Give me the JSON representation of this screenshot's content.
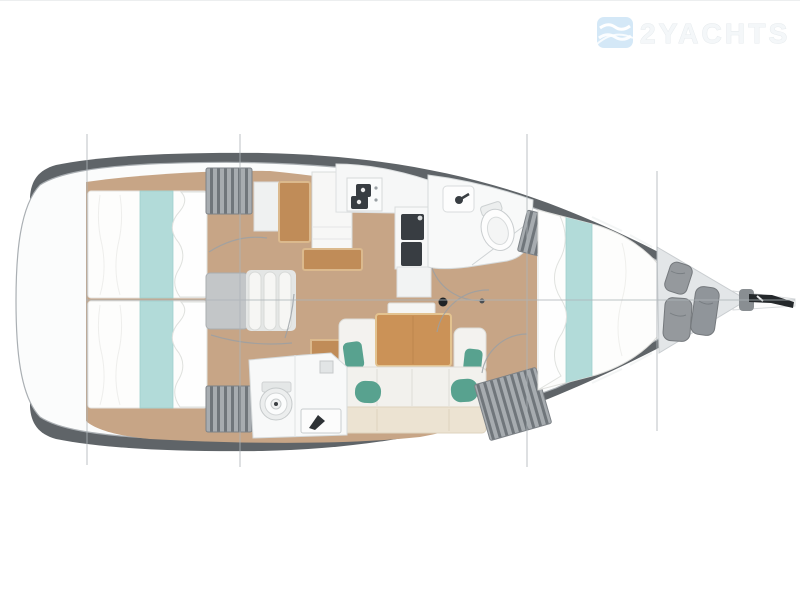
{
  "watermark": {
    "logo_icon": "waves-logo-icon",
    "text": "2YACHTS"
  },
  "colors": {
    "background": "#ffffff",
    "hull_rim": "#5f6468",
    "deck": "#fbfcfc",
    "floor_wood": "#c7a586",
    "furniture_wood": "#c08c58",
    "bed_teal": "#b2dbd9",
    "pillow_teal": "#58a28f",
    "appliance_dark": "#383d42",
    "locker_gray": "#9aa0a4",
    "line_gray": "#adb4b8",
    "watermark_blue": "#cde4f6",
    "watermark_text": "#f4f7f9"
  }
}
